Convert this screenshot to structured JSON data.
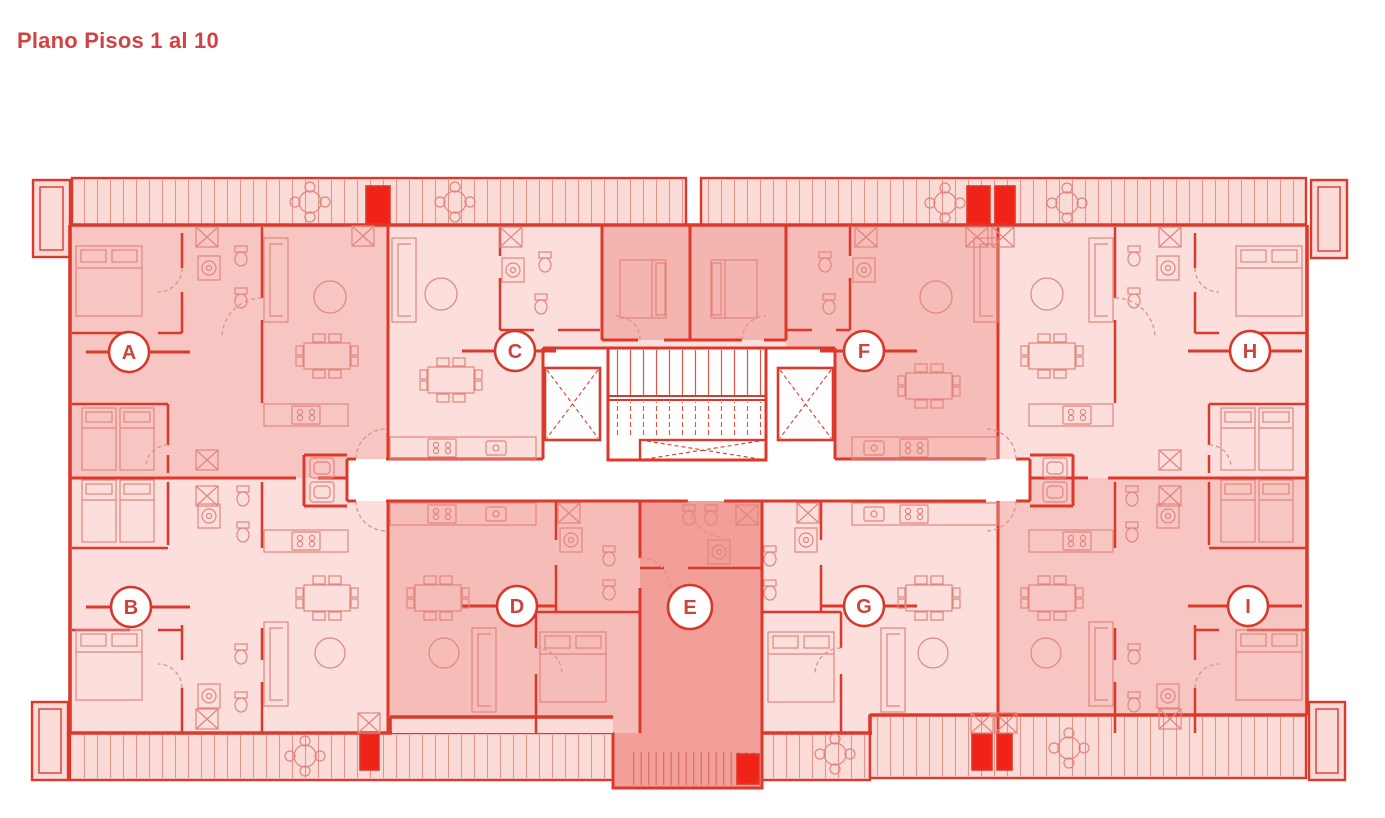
{
  "title": "Plano Pisos 1 al 10",
  "units": [
    {
      "label": "A"
    },
    {
      "label": "B"
    },
    {
      "label": "C"
    },
    {
      "label": "D"
    },
    {
      "label": "E"
    },
    {
      "label": "F"
    },
    {
      "label": "G"
    },
    {
      "label": "H"
    },
    {
      "label": "I"
    }
  ],
  "colors": {
    "wall_red": "#db392b",
    "title_red": "#d14343",
    "label_red": "#cf413c",
    "fill_light_pink": "#fcdfdd",
    "fill_mid_pink": "#f8c6c2",
    "fill_mid_dark_pink": "#f6bcb8",
    "fill_bedroom_block": "#f4b4b0",
    "fill_unit_e": "#f19f98",
    "fill_balcony": "#fbdbd8",
    "duct_red": "#f12318",
    "furniture_line": "#e2857c",
    "background": "#ffffff"
  }
}
